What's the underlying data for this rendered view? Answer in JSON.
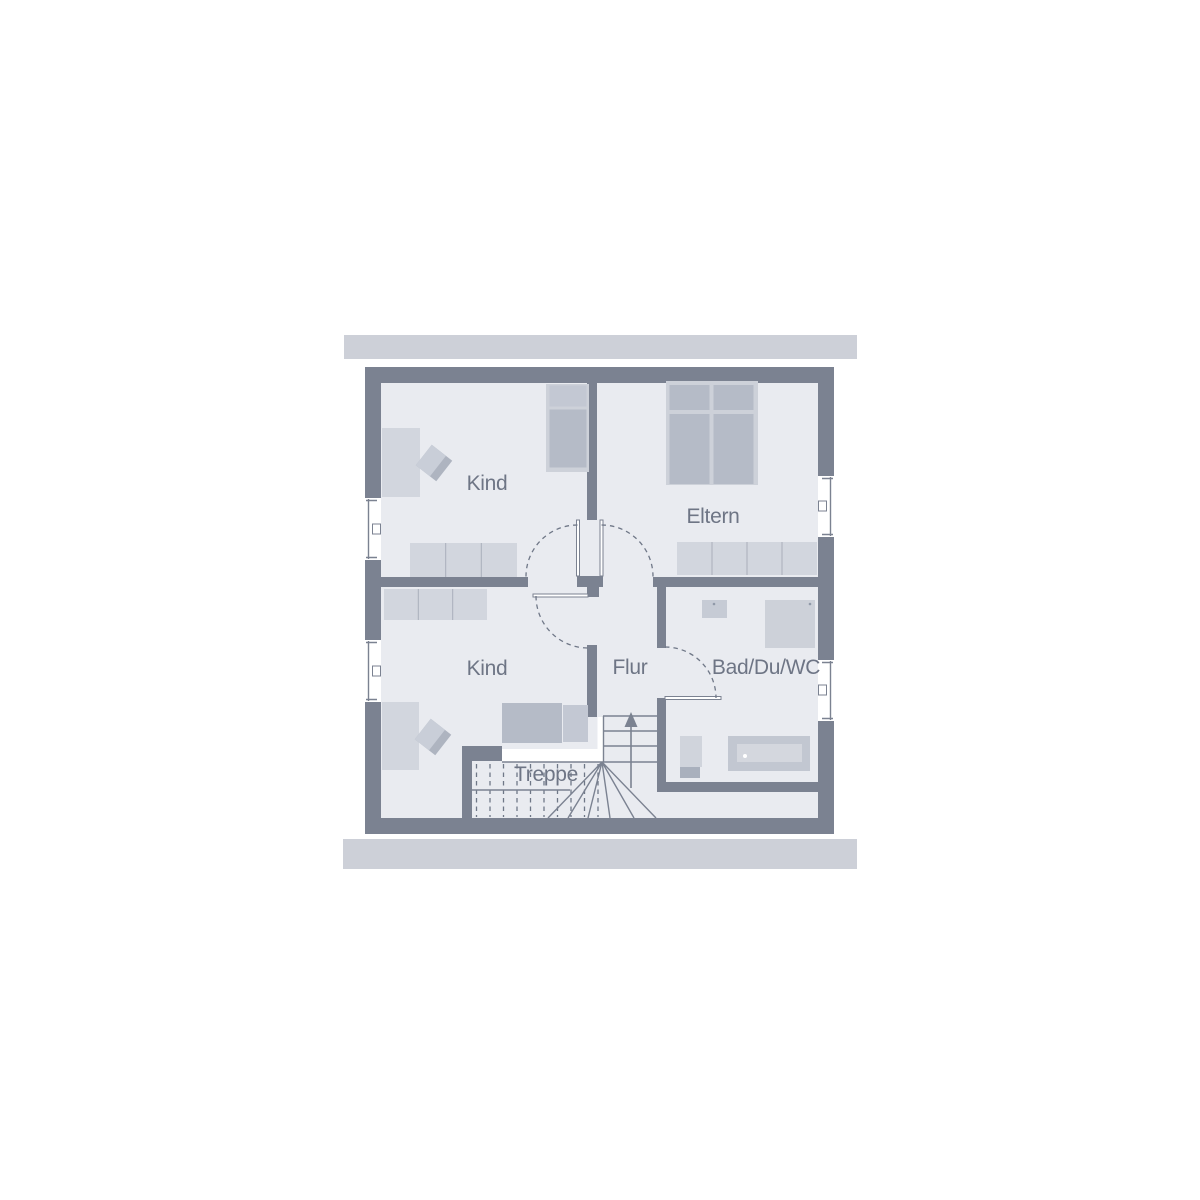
{
  "floorplan": {
    "type": "floor-plan-upper-storey",
    "rooms": {
      "kind1": {
        "label": "Kind"
      },
      "eltern": {
        "label": "Eltern"
      },
      "kind2": {
        "label": "Kind"
      },
      "flur": {
        "label": "Flur"
      },
      "bad": {
        "label": "Bad/Du/WC"
      },
      "treppe": {
        "label": "Treppe"
      }
    },
    "colors": {
      "wall": "#7B8291",
      "floor": "#E9EBF0",
      "roof_strip": "#CDD0D8",
      "furniture_light": "#D2D6DE",
      "furniture_medium": "#B5BBC7",
      "bed_frame": "#CDD1D9",
      "pillow": "#C3C8D3",
      "landing_white": "#FFFFFF",
      "label_text": "#6E7585",
      "background": "#FFFFFF"
    }
  }
}
